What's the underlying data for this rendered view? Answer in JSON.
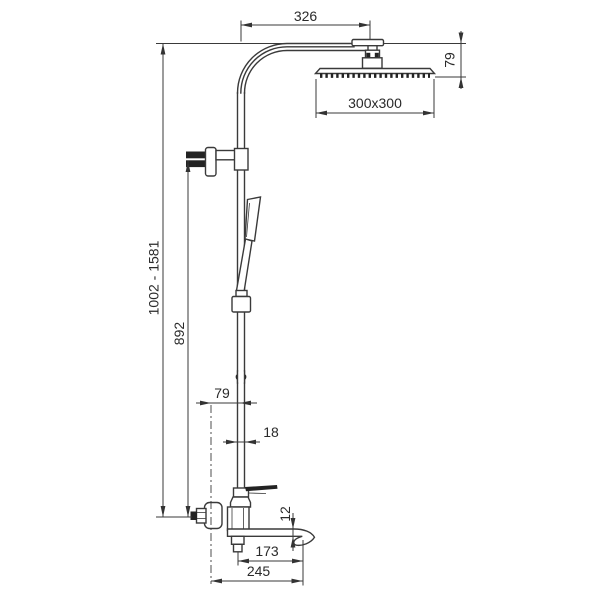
{
  "drawing": {
    "background": "#ffffff",
    "line_color": "#3a3a3a",
    "dark_fill": "#232323",
    "text_color": "#2a2a2a",
    "dims": {
      "top_width": "326",
      "head_drop": "79",
      "head_size": "300x300",
      "overall_height": "1002 - 1581",
      "riser_height": "892",
      "wall_offset": "79",
      "pipe_diameter": "18",
      "spout_thickness": "12",
      "spout_reach": "173",
      "overall_depth": "245"
    }
  }
}
